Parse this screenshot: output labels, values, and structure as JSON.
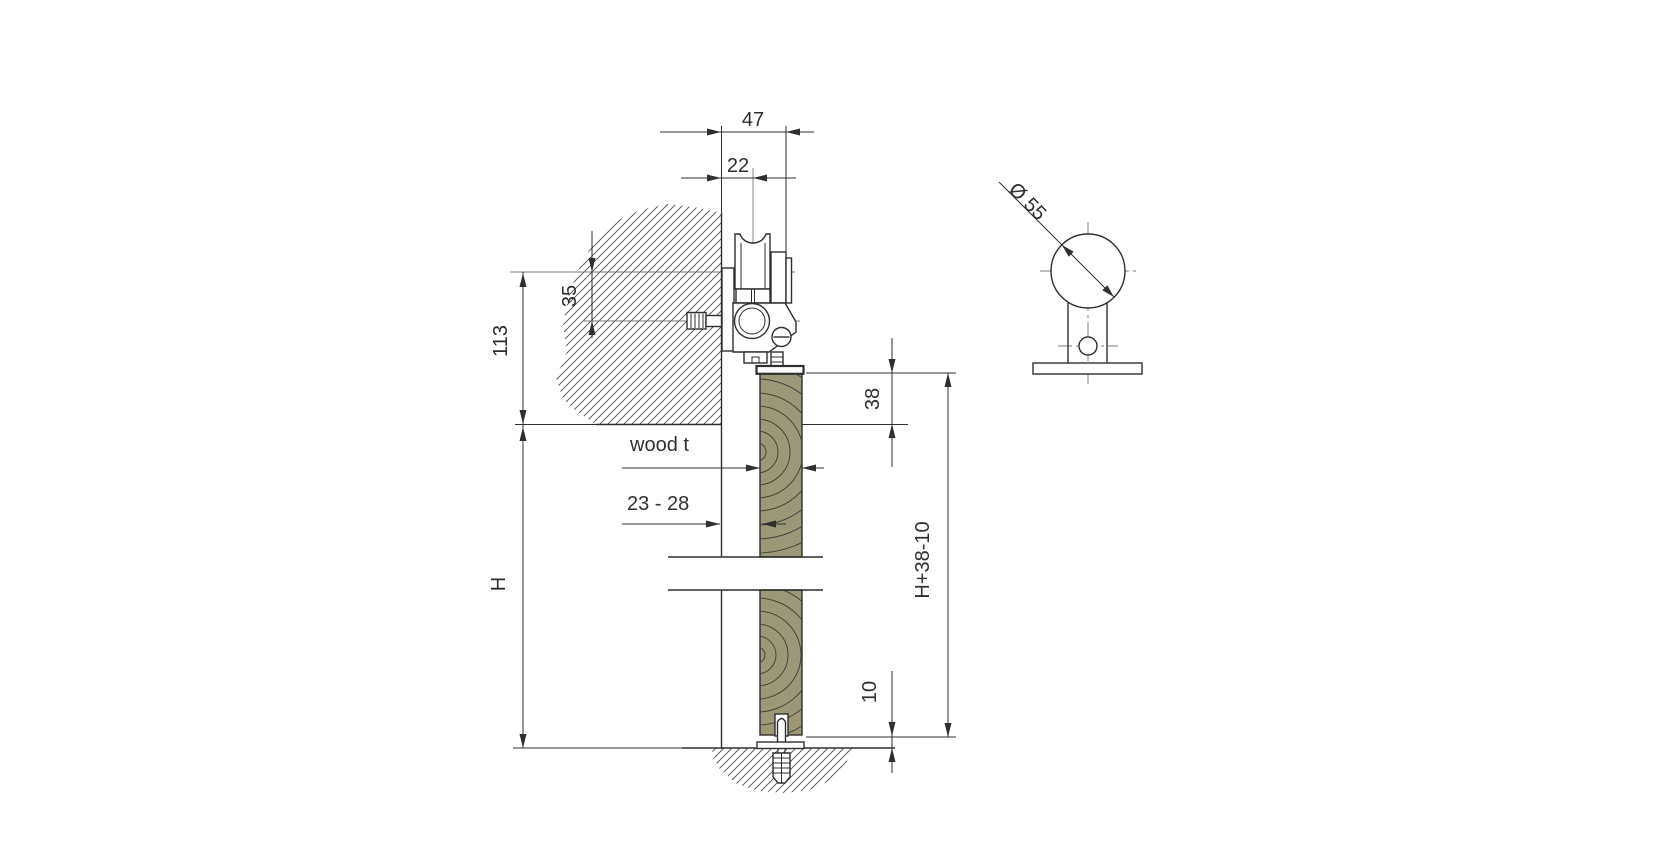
{
  "title": "Sliding door roller fitting installation drawing",
  "labels": {
    "overall_projection": "47",
    "wall_to_track_center": "22",
    "track_to_bolt_center": "35",
    "track_to_opening_top": "113",
    "door_overlap_top": "38",
    "opening_height": "H",
    "door_height_formula": "H+38-10",
    "floor_clearance": "10",
    "wood_thickness_label": "wood t",
    "wood_thickness_range": "23 - 28",
    "roller_diameter": "Ø 55"
  },
  "colors": {
    "line": "#2f2f2f",
    "centerline": "#7a7a7a",
    "wood_fill": "#9c9877",
    "wood_ring": "#45443b",
    "hatch": "#4c4c4c",
    "background": "#ffffff"
  }
}
